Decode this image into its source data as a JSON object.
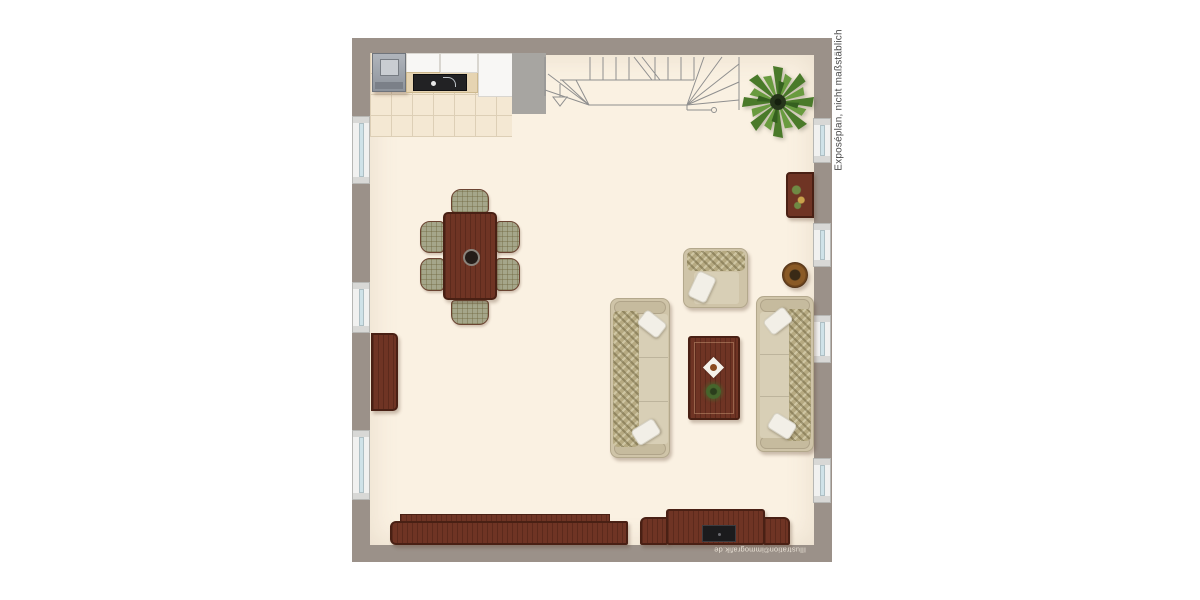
{
  "annotations": {
    "side_note": "Exposéplan, nicht maßstäblich",
    "credit": "Illustration©immografik.de"
  },
  "colors": {
    "background": "#ffffff",
    "wall": "#9b9189",
    "floor": "#faf1e2",
    "kitchen_tile": "#f4e8d3",
    "tile_line": "#ddcfb6",
    "counter_white": "#f8f7f5",
    "appliance_grey": "#9da3ab",
    "cooktop_black": "#222224",
    "wall_stub_grey": "#a7a5a1",
    "stair_line": "#8f8f8f",
    "plant_green": "#4a7a2a",
    "wood_brown": "#6f3424",
    "wood_edge": "#492014",
    "sofa_beige": "#cfc4a8",
    "sofa_seat": "#d8cfb6",
    "cushion_pattern": "#b6aa82",
    "pillow_white": "#f2efe7",
    "chair_plaid": "#a5a68a",
    "window_frame": "#f1f1f0",
    "window_glass": "#cfe2e8",
    "note_text": "#4a4a4a"
  },
  "floorplan": {
    "type": "floor-plan",
    "room": "Open living / dining room with kitchenette and winder staircase",
    "windows_left": 3,
    "windows_right": 4,
    "elements": [
      "kitchen unit with stove, sink and tiled floor",
      "interior wall stub",
      "winder staircase with direction arrow and newel post",
      "potted palm plant",
      "small sideboard at top right wall",
      "round drum side table",
      "dining table with centerpiece bowl and six plaid chairs",
      "tall sideboard at left wall",
      "armchair with throw",
      "two three-seater sofas with patterned back cushions and white pillows",
      "coffee table with tray and potted plant",
      "long sideboard along bottom wall",
      "TV lowboard with television"
    ]
  }
}
